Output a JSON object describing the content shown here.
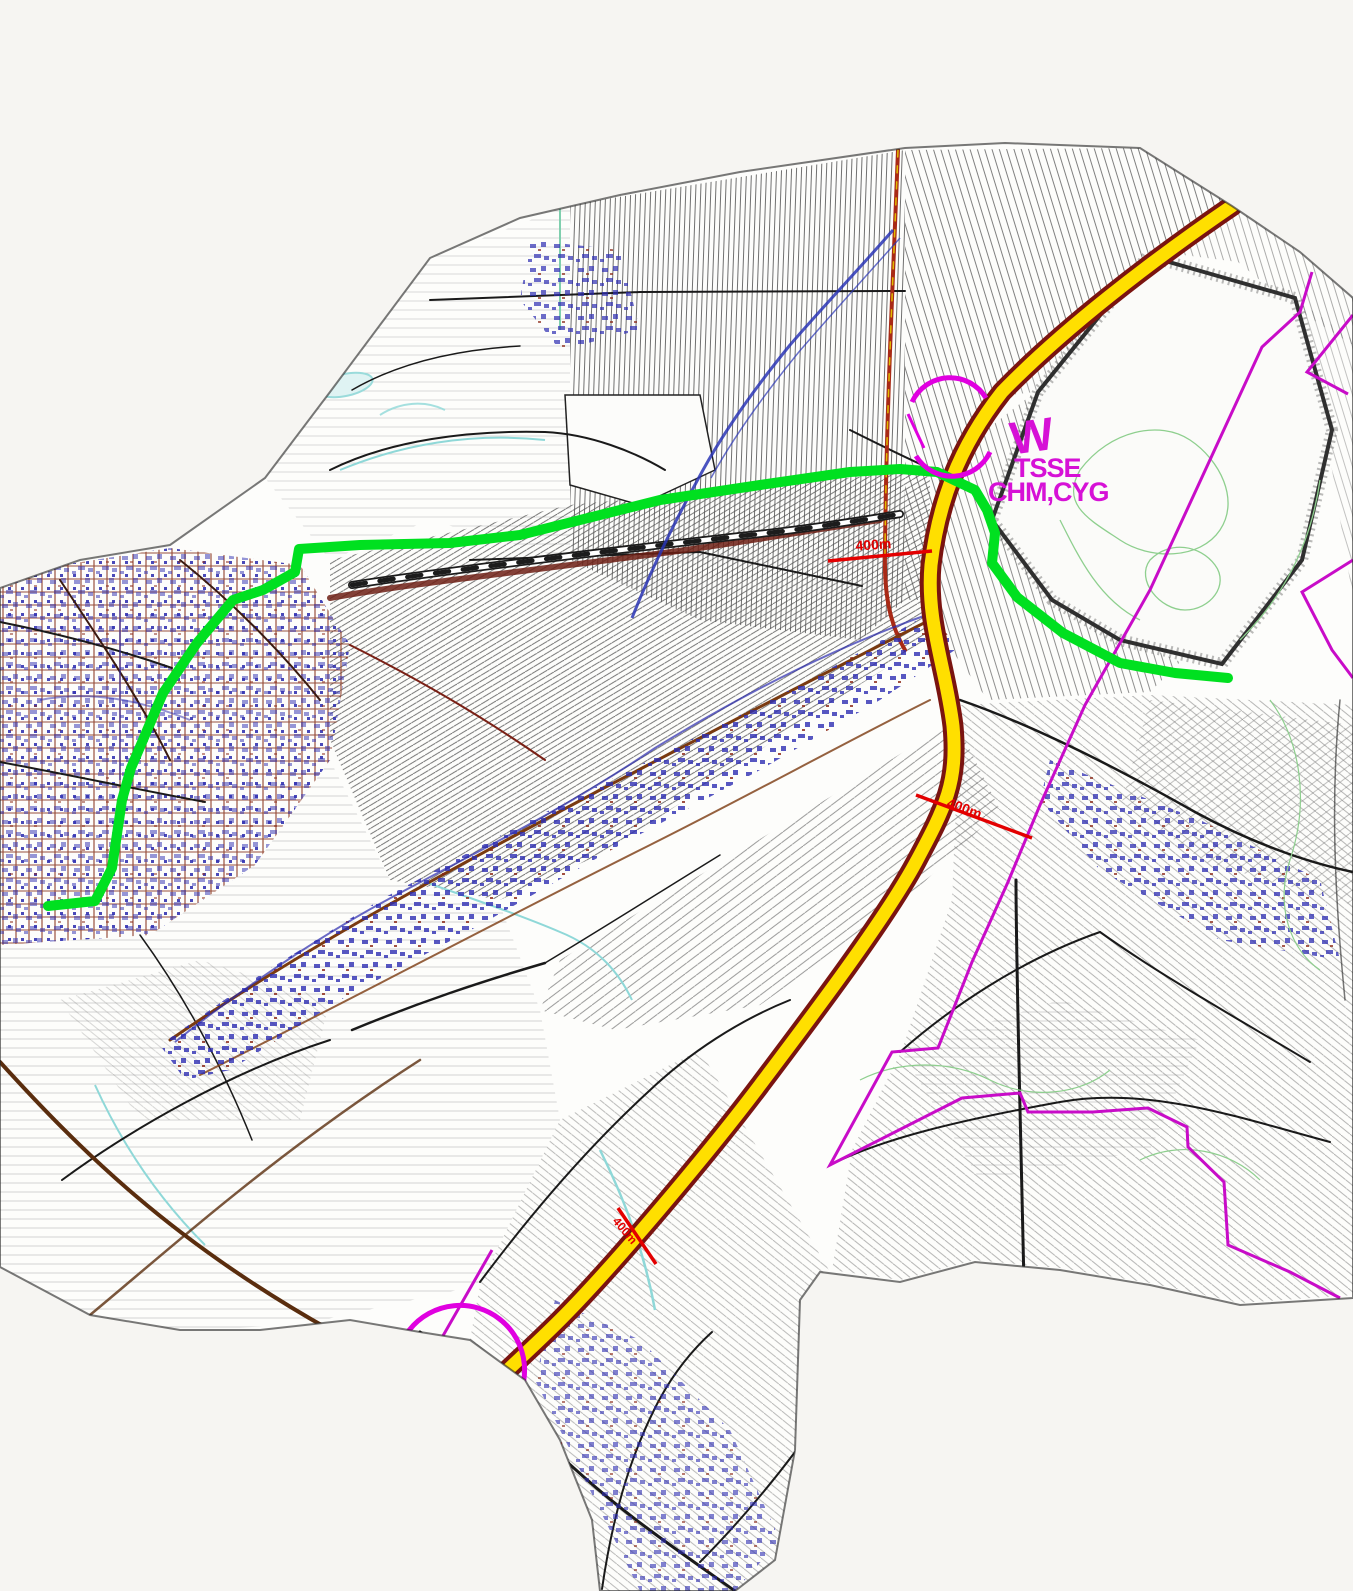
{
  "map": {
    "type": "cadastral-route-plan",
    "overlay_colors": {
      "planned_route_fill": "#ffdf00",
      "planned_route_casing": "#7a1410",
      "secondary_route": "#00e020",
      "admin_boundary": "#c80cc8",
      "annotation_text": "#d611d6",
      "distance_marker": "#e30000"
    },
    "annotations": {
      "north_interchange": {
        "symbol": "W",
        "line1": "TSSE",
        "line2": "CHM,CYG"
      },
      "south_interchange": {
        "symbol": "W",
        "line1": "CHM,JAD"
      },
      "distance_markers": [
        {
          "label": "400m"
        },
        {
          "label": "400m"
        },
        {
          "label": "400m"
        },
        {
          "label": "400m"
        }
      ]
    }
  }
}
